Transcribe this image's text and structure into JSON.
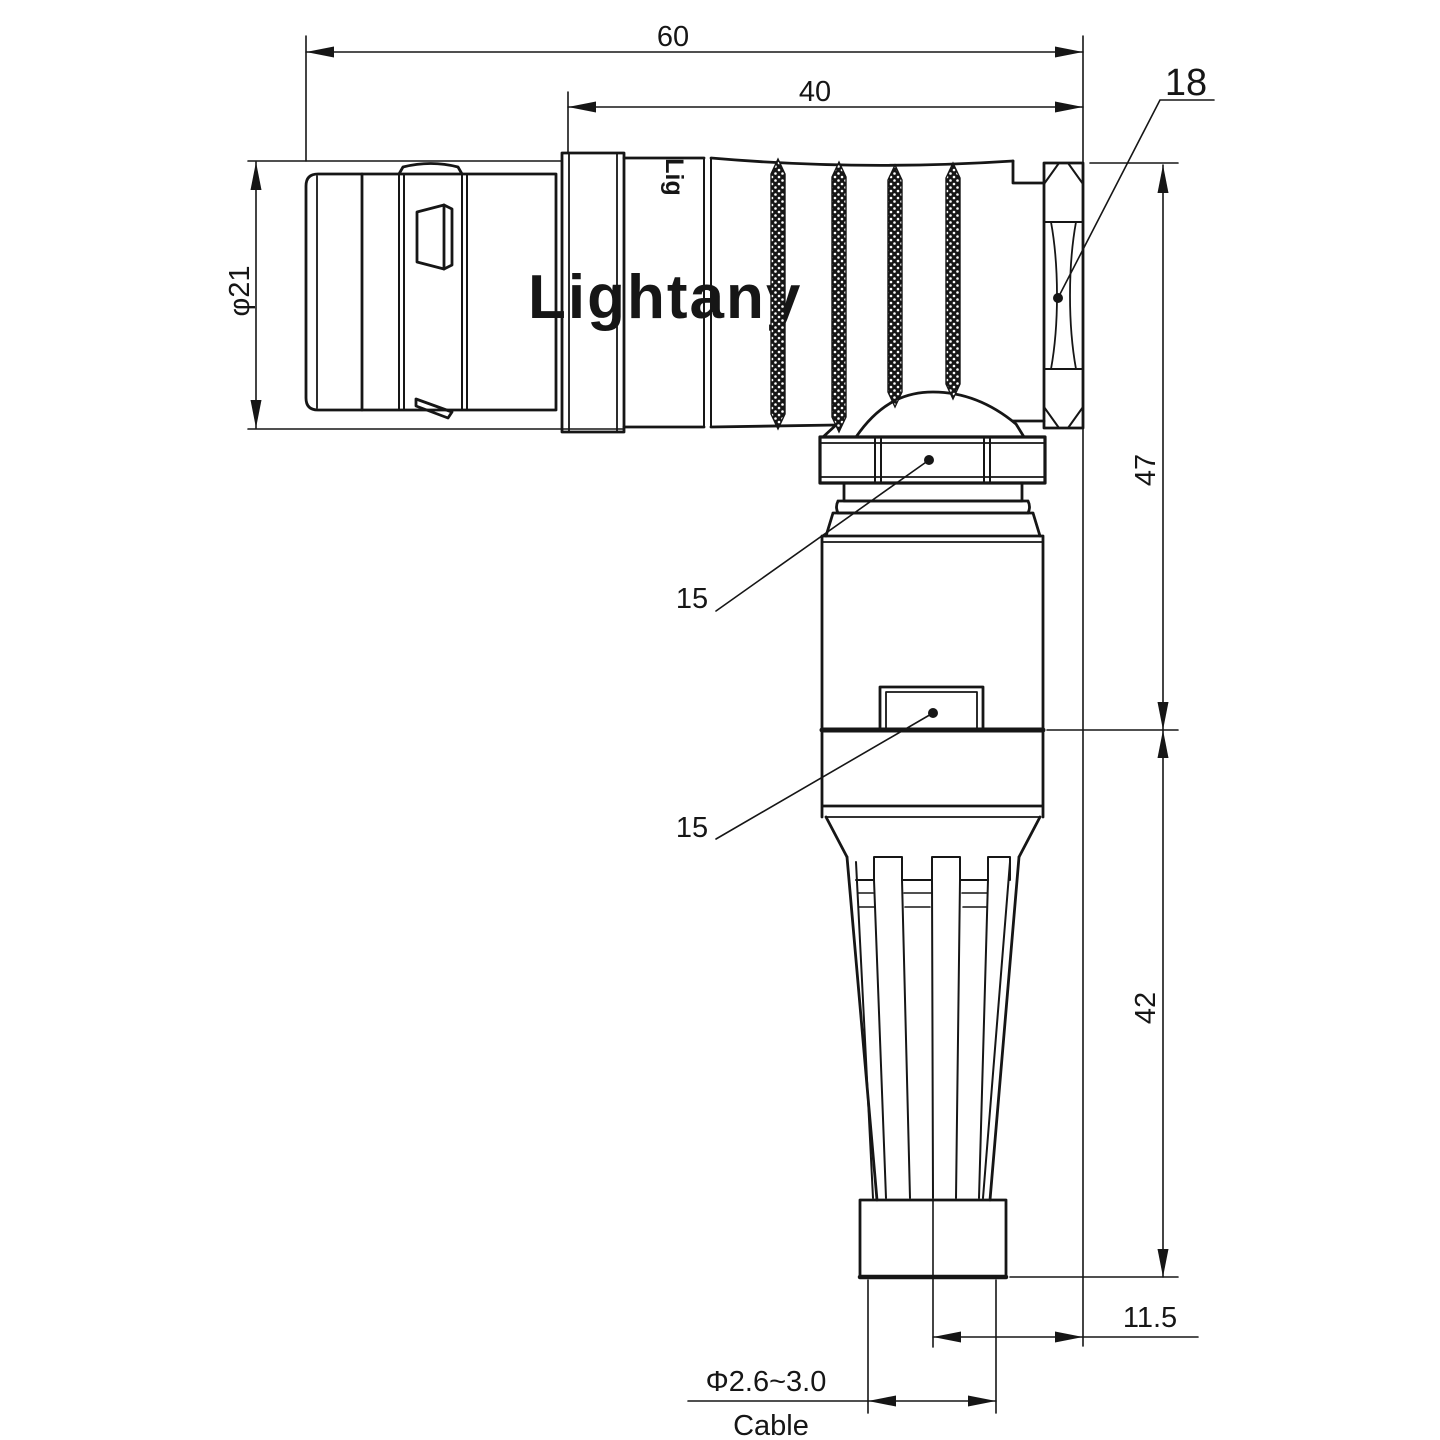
{
  "page": {
    "background": "#ffffff",
    "line_color": "#161616"
  },
  "watermark": {
    "text": "Lightany",
    "color": "#f3bcbc"
  },
  "engraving": {
    "text": "Lig"
  },
  "labels": {
    "top_total": "60",
    "top_inner": "40",
    "left_diameter": "φ21",
    "hex_size": "18",
    "right_upper": "47",
    "right_lower": "42",
    "bottom_offset": "11.5",
    "cable_diameter": "Φ2.6~3.0",
    "cable_word": "Cable",
    "callout_upper": "15",
    "callout_lower": "15"
  }
}
